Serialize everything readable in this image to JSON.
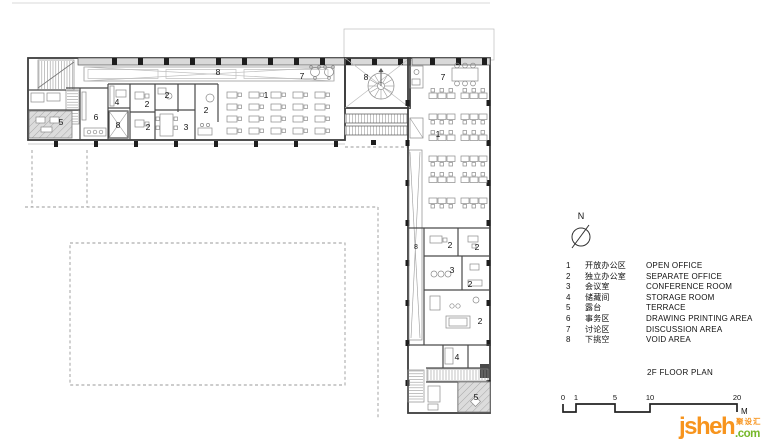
{
  "plan": {
    "room_labels": [
      "5",
      "6",
      "4",
      "8",
      "2",
      "2",
      "2",
      "3",
      "2",
      "8",
      "1",
      "7",
      "8",
      "7",
      "1",
      "8",
      "2",
      "2",
      "3",
      "2",
      "2",
      "4",
      "5"
    ]
  },
  "north": {
    "label": "N"
  },
  "legend": {
    "items": [
      {
        "num": "1",
        "zh": "开放办公区",
        "en": "OPEN OFFICE"
      },
      {
        "num": "2",
        "zh": "独立办公室",
        "en": "SEPARATE OFFICE"
      },
      {
        "num": "3",
        "zh": "会议室",
        "en": "CONFERENCE ROOM"
      },
      {
        "num": "4",
        "zh": "储藏间",
        "en": "STORAGE ROOM"
      },
      {
        "num": "5",
        "zh": "露台",
        "en": "TERRACE"
      },
      {
        "num": "6",
        "zh": "事务区",
        "en": "DRAWING PRINTING AREA"
      },
      {
        "num": "7",
        "zh": "讨论区",
        "en": "DISCUSSION AREA"
      },
      {
        "num": "8",
        "zh": "下挑空",
        "en": "VOID AREA"
      }
    ],
    "title": "2F FLOOR PLAN"
  },
  "scale_bar": {
    "ticks": [
      "0",
      "1",
      "5",
      "10",
      "20"
    ],
    "unit": "M"
  },
  "logo": {
    "name": "jsheh",
    "tld": ".com",
    "cn": "聚设汇"
  },
  "colors": {
    "logo_orange": "#F7941D",
    "logo_green": "#76B82A",
    "wall": "#3c3c3c",
    "hatch_fill": "#dcdcdc",
    "dashed": "#9a9a9a"
  }
}
